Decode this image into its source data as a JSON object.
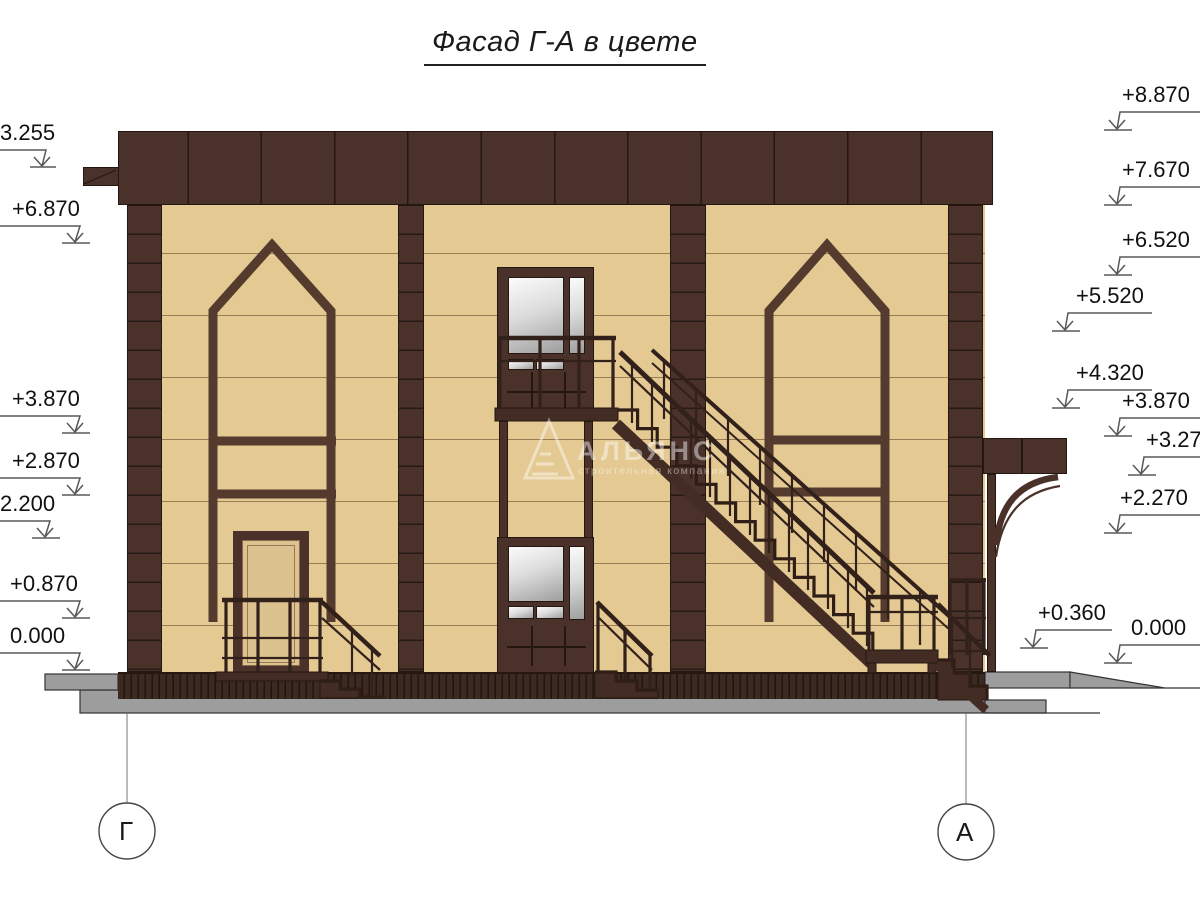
{
  "title": {
    "text": "Фасад Г-А в цвете"
  },
  "watermark": {
    "name": "АЛЬЯНС",
    "subtitle": "строительная компания"
  },
  "axis_labels": {
    "left": "Г",
    "right": "А"
  },
  "elevation_markers": {
    "left": [
      {
        "label": "3.255"
      },
      {
        "label": "+6.870"
      },
      {
        "label": "+3.870"
      },
      {
        "label": "+2.870"
      },
      {
        "label": "2.200"
      },
      {
        "label": "+0.870"
      },
      {
        "label": "0.000"
      }
    ],
    "right": [
      {
        "label": "+8.870"
      },
      {
        "label": "+7.670"
      },
      {
        "label": "+6.520"
      },
      {
        "label": "+5.520"
      },
      {
        "label": "+4.320"
      },
      {
        "label": "+3.870"
      },
      {
        "label": "+3.27"
      },
      {
        "label": "+2.270"
      },
      {
        "label": "+0.360"
      },
      {
        "label": "0.000"
      }
    ]
  },
  "colors": {
    "tan": "#e4c993",
    "brown": "#4a322a",
    "brown_dark": "#241710",
    "frame": "#543b2d",
    "stair": "#32211a",
    "beam": "#422c23",
    "plinth": "#3c2922",
    "leaf": "#dcc28e",
    "gray": "#9d9d9d",
    "gray_edge": "#333333",
    "dim": "#585858",
    "ink": "#111111",
    "glass_hi": "#fbfbfb",
    "glass_lo": "#9e9e9e",
    "watermark": "rgba(255,255,255,0.45)"
  }
}
